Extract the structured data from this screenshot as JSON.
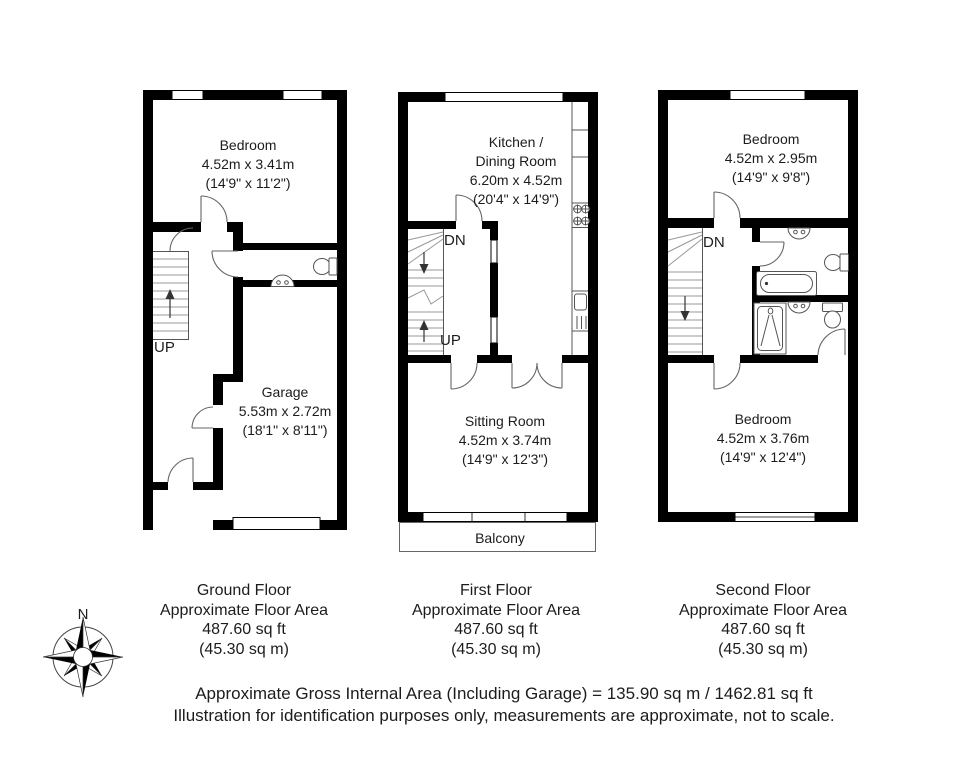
{
  "rooms": {
    "ground_bedroom": {
      "name": "Bedroom",
      "metric": "4.52m x 3.41m",
      "imperial": "(14'9\" x 11'2\")"
    },
    "garage": {
      "name": "Garage",
      "metric": "5.53m x 2.72m",
      "imperial": "(18'1\" x 8'11\")"
    },
    "kitchen": {
      "name_line1": "Kitchen /",
      "name_line2": "Dining Room",
      "metric": "6.20m x 4.52m",
      "imperial": "(20'4\" x 14'9\")"
    },
    "sitting": {
      "name": "Sitting Room",
      "metric": "4.52m x 3.74m",
      "imperial": "(14'9\" x 12'3\")"
    },
    "balcony": {
      "name": "Balcony"
    },
    "second_bedroom_top": {
      "name": "Bedroom",
      "metric": "4.52m x 2.95m",
      "imperial": "(14'9\" x 9'8\")"
    },
    "second_bedroom_bottom": {
      "name": "Bedroom",
      "metric": "4.52m x 3.76m",
      "imperial": "(14'9\" x 12'4\")"
    }
  },
  "stairs": {
    "ground_up": "UP",
    "first_dn": "DN",
    "first_up": "UP",
    "second_dn": "DN"
  },
  "compass": {
    "north": "N"
  },
  "areas": {
    "ground": {
      "floor_name": "Ground Floor",
      "approx": "Approximate Floor Area",
      "sqft": "487.60 sq ft",
      "sqm": "(45.30 sq m)"
    },
    "first": {
      "floor_name": "First Floor",
      "approx": "Approximate Floor Area",
      "sqft": "487.60 sq ft",
      "sqm": "(45.30 sq m)"
    },
    "second": {
      "floor_name": "Second Floor",
      "approx": "Approximate Floor Area",
      "sqft": "487.60 sq ft",
      "sqm": "(45.30 sq m)"
    }
  },
  "footer": {
    "line1": "Approximate Gross Internal Area (Including Garage) = 135.90 sq m / 1462.81 sq ft",
    "line2": "Illustration for identification purposes only, measurements are approximate, not to scale."
  }
}
